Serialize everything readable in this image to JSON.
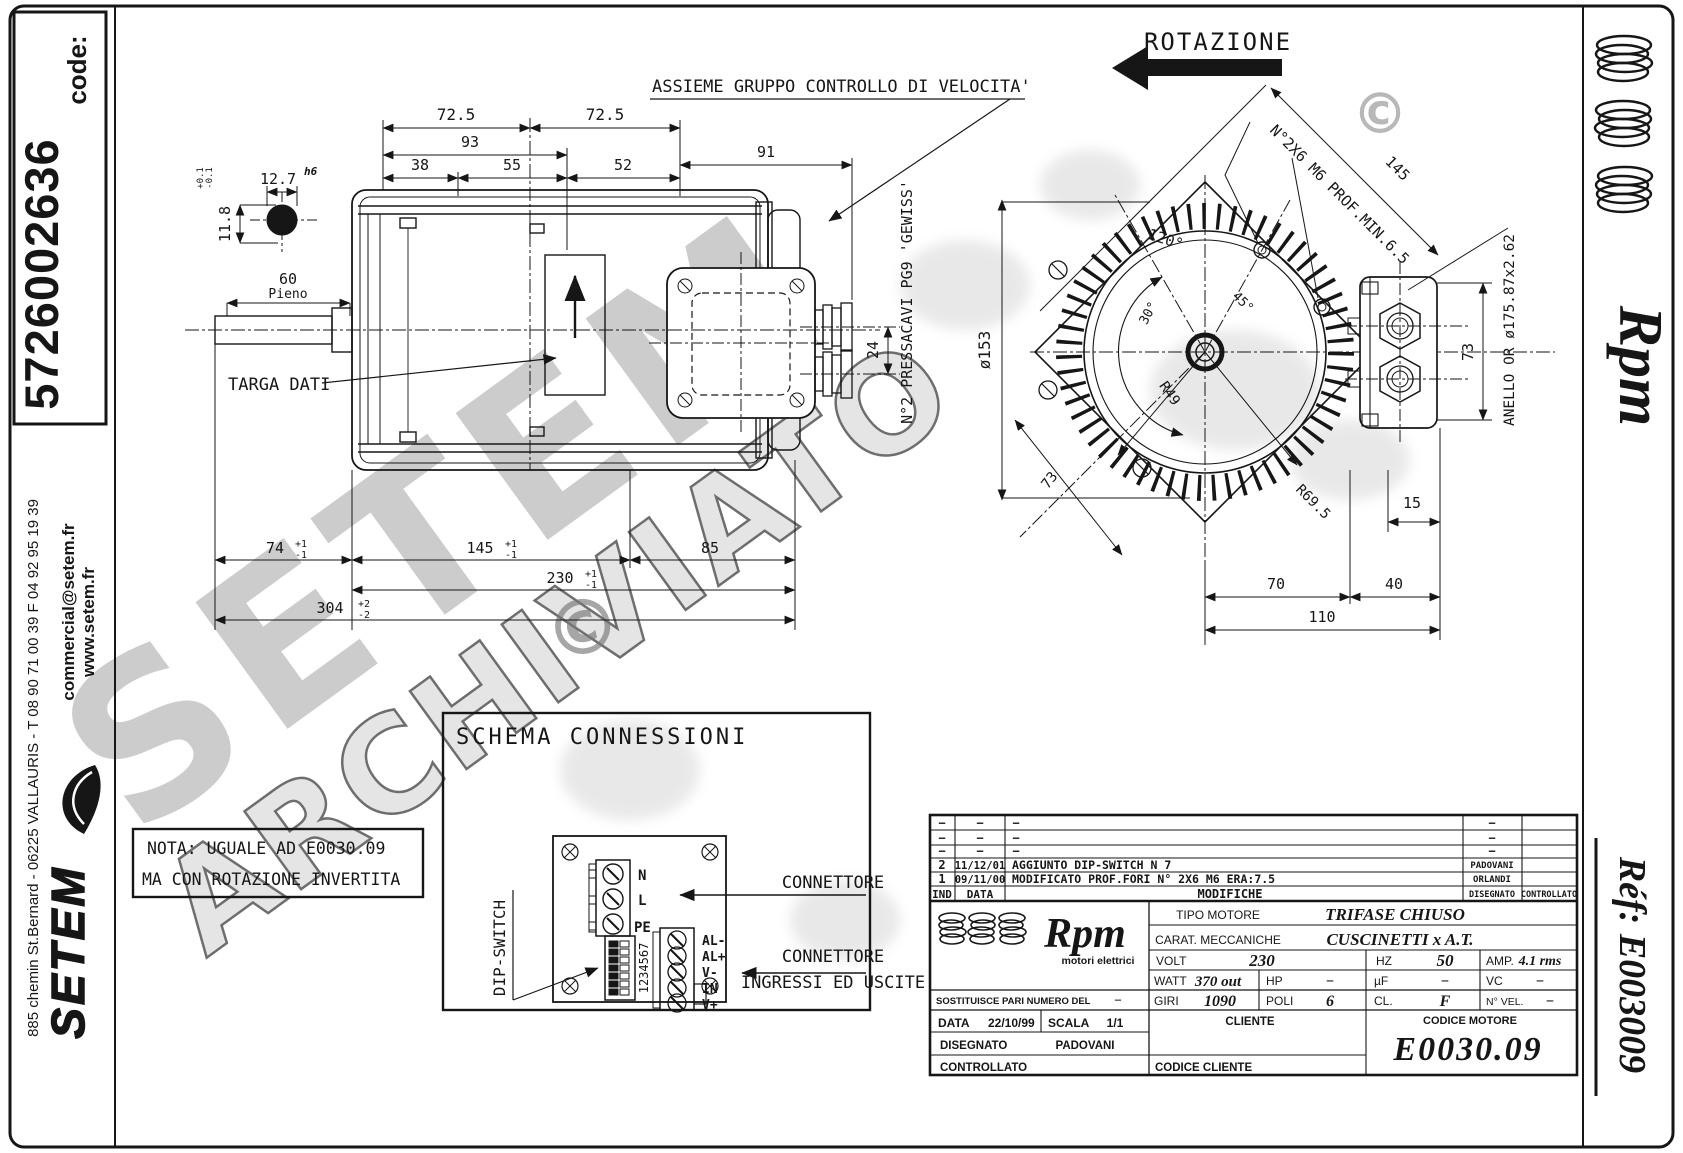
{
  "frame": {
    "code_label": "code:",
    "code_value": "5726002636"
  },
  "left_margin": {
    "website": "www.setem.fr",
    "email": "commercial@setem.fr",
    "address": "885 chemin St.Bernard  -  06225 VALLAURIS  -  T 08 90 71 00 39   F 04 92 95 19 39",
    "logo": "SETEM"
  },
  "right_margin": {
    "brand_script": "Rpm",
    "ref_label": "Réf:  E003009"
  },
  "watermark": {
    "big": "SETEM",
    "stamp": "ARCHIVIATO",
    "copyright": "©"
  },
  "side_view": {
    "labels": {
      "assembly": "ASSIEME GRUPPO CONTROLLO DI VELOCITA'",
      "targa": "TARGA DATI",
      "pressacavi": "N°2 PRESSACAVI PG9 'GEWISS'",
      "pieno": "Pieno"
    },
    "dims": {
      "w1": "72.5",
      "w2": "72.5",
      "w3": "93",
      "w4": "38",
      "w5": "55",
      "w6": "52",
      "w7": "91",
      "shaft_len": "60",
      "gland": "24",
      "b1": "74",
      "b1_sup": "+1",
      "b1_sub": "-1",
      "b2": "145",
      "b2_sup": "+1",
      "b2_sub": "-1",
      "b3": "85",
      "b4": "230",
      "b4_sup": "+1",
      "b4_sub": "-1",
      "b5": "304",
      "b5_sup": "+2",
      "b5_sub": "-2"
    },
    "key_detail": {
      "width": "12.7",
      "fit": "h6",
      "tol_plus": "+0.1",
      "tol_minus": "-0.1",
      "height": "11.8"
    }
  },
  "front_view": {
    "labels": {
      "rotation": "ROTAZIONE",
      "holes": "N°2X6 M6 PROF.MIN.6.5",
      "anello": "ANELLO OR ø175.87x2.62"
    },
    "dims": {
      "diag": "145",
      "dia": "ø153",
      "a120": "120°",
      "a45": "45°",
      "a30": "30°",
      "r49": "R49",
      "r695": "R69.5",
      "d73a": "73",
      "d73b": "73",
      "d15": "15",
      "d70": "70",
      "d40": "40",
      "d110": "110"
    }
  },
  "schema": {
    "title": "SCHEMA CONNESSIONI",
    "dip_label": "DIP-SWITCH",
    "dip_numbers": "1234567",
    "pe": "PE",
    "l": "L",
    "n": "N",
    "io": [
      "AL-",
      "AL+",
      "V-",
      "IN",
      "V+"
    ],
    "connettore": "CONNETTORE",
    "io_line1": "CONNETTORE",
    "io_line2": "INGRESSI ED USCITE"
  },
  "nota": {
    "line1": "NOTA: UGUALE AD E0030.09",
    "line2": "MA CON ROTAZIONE INVERTITA"
  },
  "title_block": {
    "rev_headers": {
      "ind": "IND",
      "data": "DATA",
      "modifiche": "MODIFICHE",
      "disegnato": "DISEGNATO",
      "controllato": "CONTROLLATO"
    },
    "rev_rows": [
      {
        "ind": "−",
        "data": "−",
        "mod": "−",
        "dis": "−"
      },
      {
        "ind": "−",
        "data": "−",
        "mod": "−",
        "dis": "−"
      },
      {
        "ind": "−",
        "data": "−",
        "mod": "−",
        "dis": "−"
      },
      {
        "ind": "2",
        "data": "11/12/01",
        "mod": "AGGIUNTO DIP-SWITCH N 7",
        "dis": "PADOVANI"
      },
      {
        "ind": "1",
        "data": "09/11/00",
        "mod": "MODIFICATO PROF.FORI N° 2X6 M6 ERA:7.5",
        "dis": "ORLANDI"
      }
    ],
    "brand": {
      "script": "Rpm",
      "tagline": "motori elettrici"
    },
    "tipo_label": "TIPO MOTORE",
    "tipo_value": "TRIFASE CHIUSO",
    "carat_label": "CARAT. MECCANICHE",
    "carat_value": "CUSCINETTI x A.T.",
    "volt_label": "VOLT",
    "volt_value": "230",
    "hz_label": "HZ",
    "hz_value": "50",
    "amp_label": "AMP.",
    "amp_value": "4.1 rms",
    "watt_label": "WATT",
    "watt_value": "370 out",
    "hp_label": "HP",
    "hp_value": "−",
    "uf_label": "µF",
    "uf_value": "−",
    "vc_label": "VC",
    "vc_value": "−",
    "sost_label": "SOSTITUISCE PARI NUMERO DEL",
    "sost_value": "−",
    "giri_label": "GIRI",
    "giri_value": "1090",
    "poli_label": "POLI",
    "poli_value": "6",
    "cl_label": "CL.",
    "cl_value": "F",
    "nvel_label": "N° VEL.",
    "nvel_value": "−",
    "data_label": "DATA",
    "data_value": "22/10/99",
    "scala_label": "SCALA",
    "scala_value": "1/1",
    "cliente_label": "CLIENTE",
    "codice_motore_label": "CODICE MOTORE",
    "codice_motore_value": "E0030.09",
    "disegnato_label": "DISEGNATO",
    "disegnato_value": "PADOVANI",
    "controllato_label": "CONTROLLATO",
    "codice_cliente_label": "CODICE CLIENTE"
  }
}
